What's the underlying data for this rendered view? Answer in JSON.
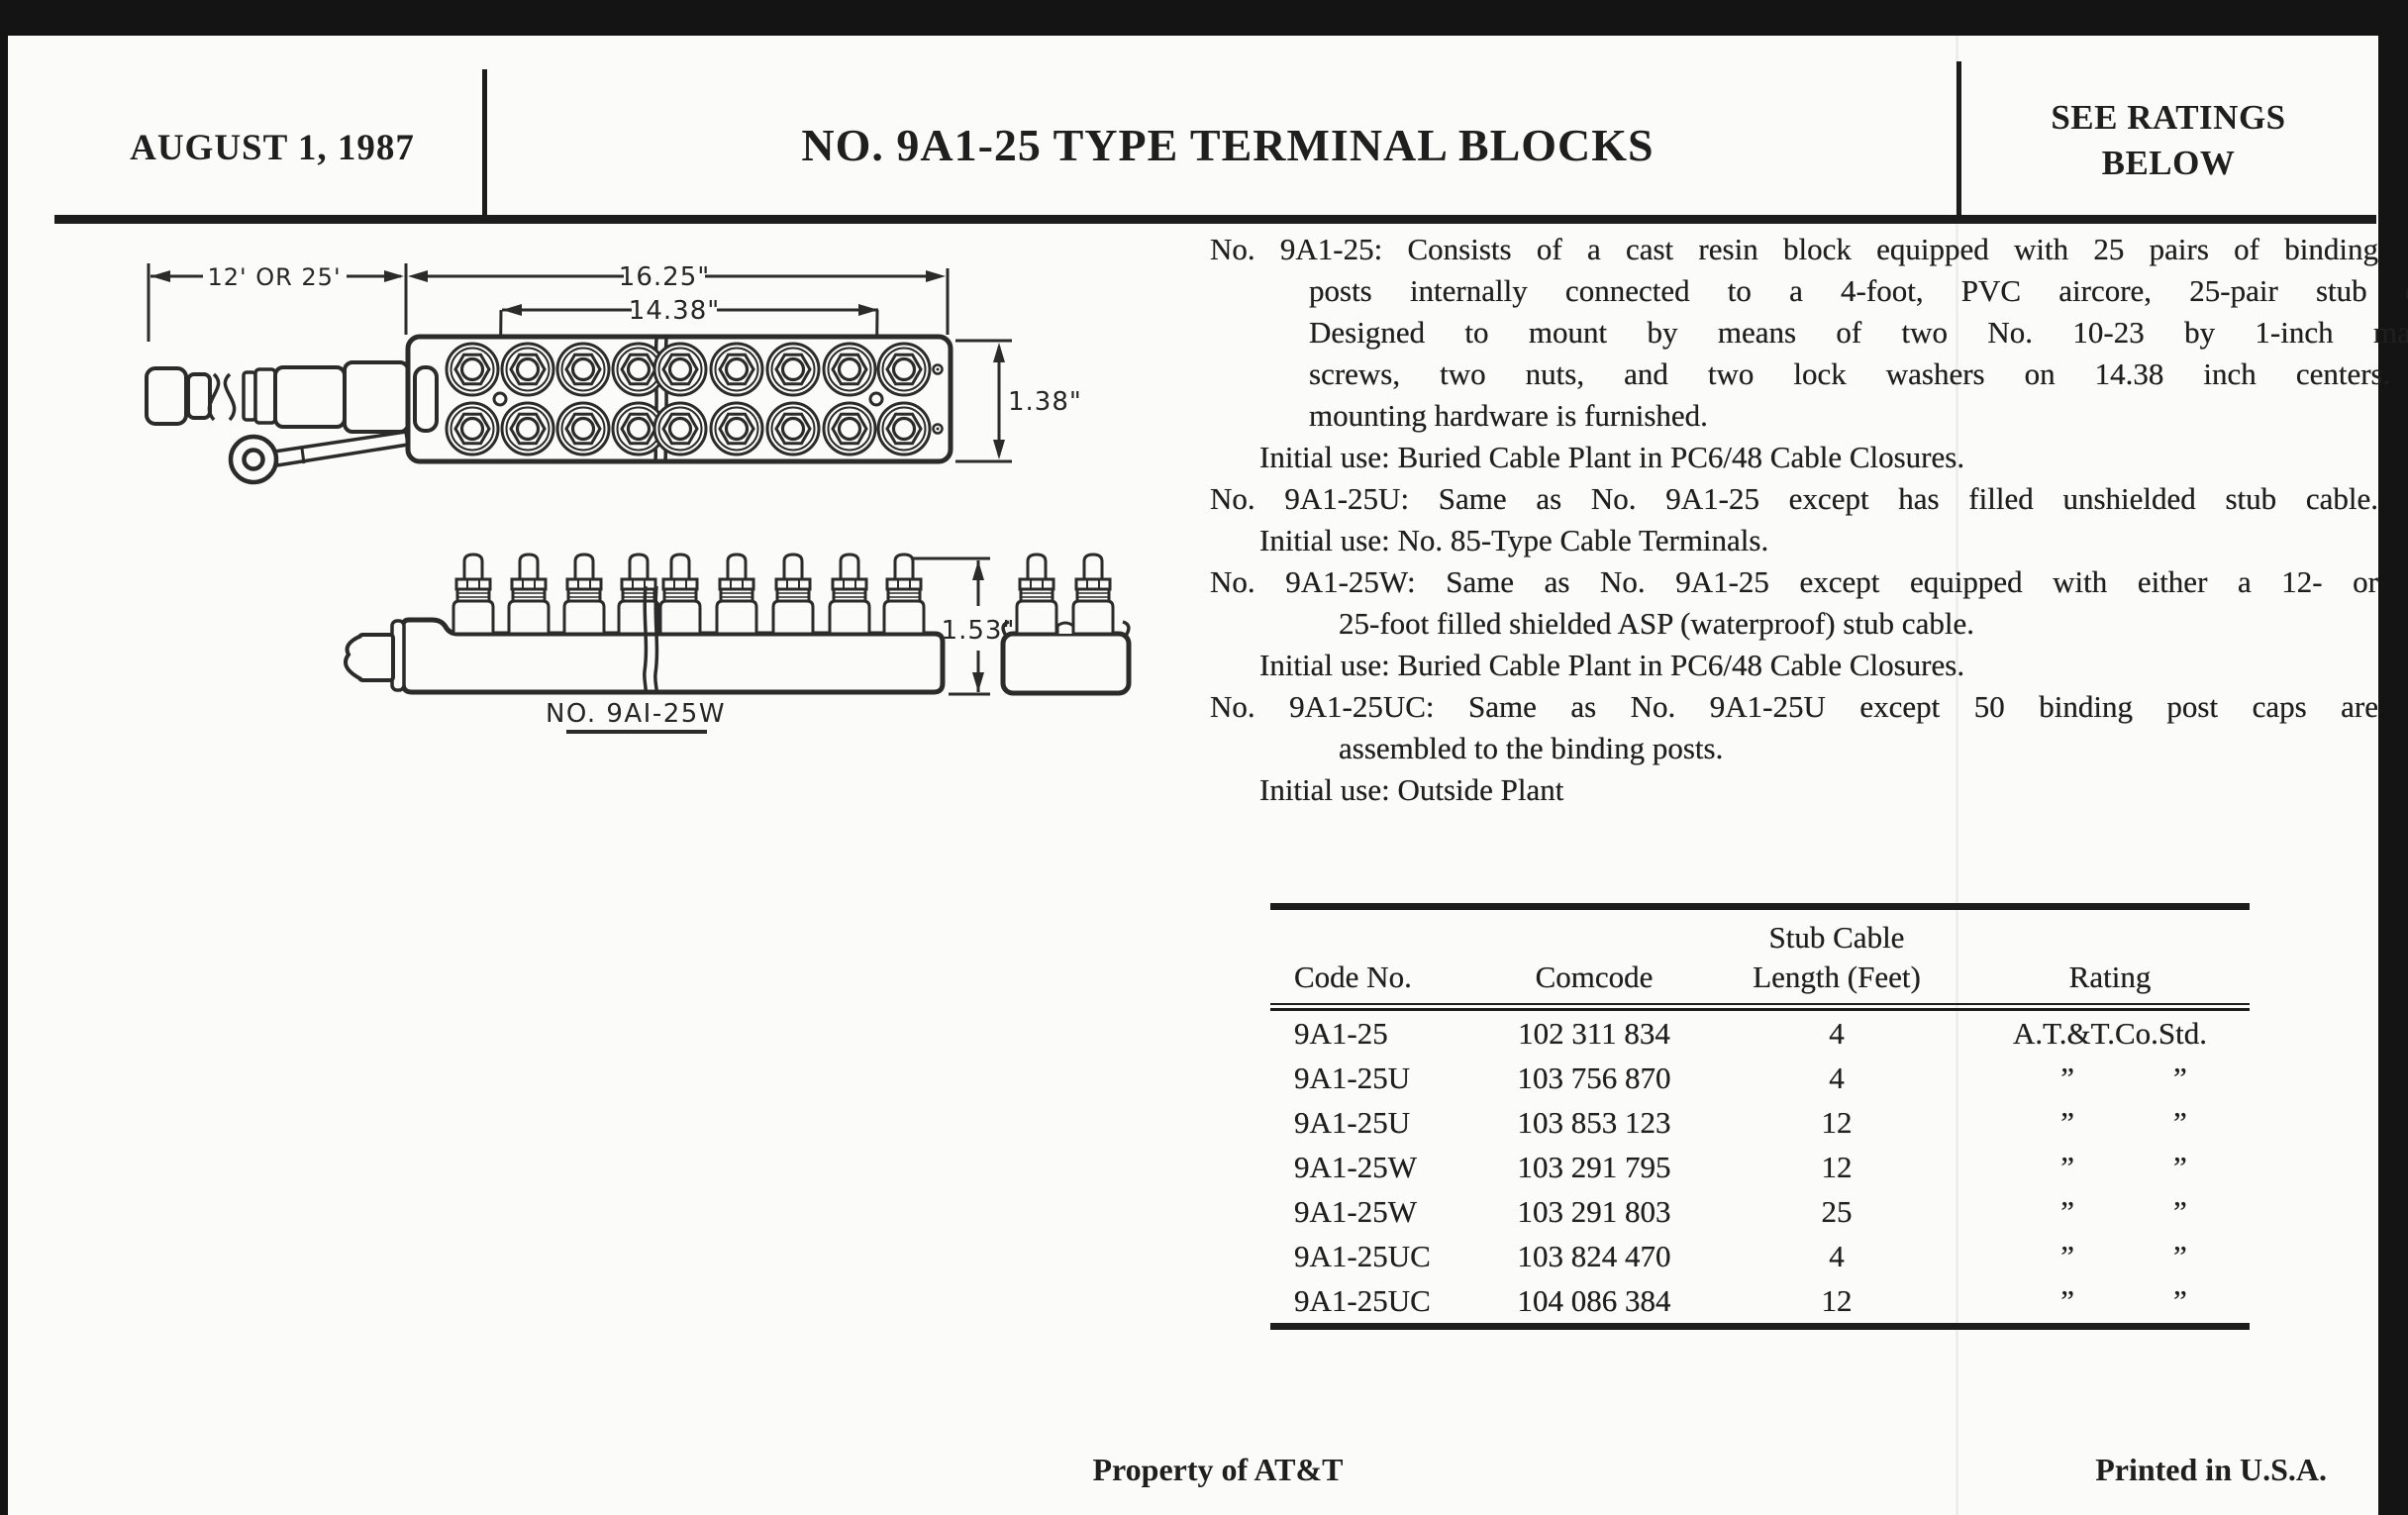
{
  "header": {
    "date": "AUGUST 1, 1987",
    "title": "NO. 9A1-25 TYPE TERMINAL BLOCKS",
    "ratings_note_line1": "SEE RATINGS",
    "ratings_note_line2": "BELOW"
  },
  "diagram": {
    "top_view": {
      "dim_cable_length": "12' OR 25'",
      "dim_overall_width": "16.25\"",
      "dim_mounting_centers": "14.38\"",
      "dim_block_height": "1.38\""
    },
    "side_view": {
      "dim_post_height": "1.53\"",
      "caption": "NO. 9AI-25W"
    }
  },
  "description": {
    "lines": [
      {
        "text": "No. 9A1-25: Consists of a cast resin block equipped with 25 pairs of binding",
        "indent": 0,
        "justify": true
      },
      {
        "text": "posts internally connected to a 4-foot, PVC aircore, 25-pair stub cable.",
        "indent": 100,
        "justify": true
      },
      {
        "text": "Designed to mount by means of two No. 10-23 by 1-inch machine",
        "indent": 100,
        "justify": true
      },
      {
        "text": "screws, two nuts, and two lock washers on 14.38 inch centers. The",
        "indent": 100,
        "justify": true
      },
      {
        "text": "mounting hardware is furnished.",
        "indent": 100,
        "justify": false
      },
      {
        "text": "Initial use: Buried Cable Plant in PC6/48 Cable Closures.",
        "indent": 50,
        "justify": false
      },
      {
        "text": "No. 9A1-25U: Same as No. 9A1-25 except has filled unshielded stub cable.",
        "indent": 0,
        "justify": true
      },
      {
        "text": "Initial use: No. 85-Type Cable Terminals.",
        "indent": 50,
        "justify": false
      },
      {
        "text": "No. 9A1-25W: Same as No. 9A1-25 except equipped with either a 12- or",
        "indent": 0,
        "justify": true
      },
      {
        "text": "25-foot filled shielded ASP (waterproof) stub cable.",
        "indent": 130,
        "justify": false
      },
      {
        "text": "Initial use: Buried Cable Plant in PC6/48 Cable Closures.",
        "indent": 50,
        "justify": false
      },
      {
        "text": "No. 9A1-25UC: Same as No. 9A1-25U except 50 binding post caps are",
        "indent": 0,
        "justify": true
      },
      {
        "text": "assembled to the binding posts.",
        "indent": 130,
        "justify": false
      },
      {
        "text": "Initial use: Outside Plant",
        "indent": 50,
        "justify": false
      }
    ]
  },
  "table": {
    "col_headers": {
      "code": "Code No.",
      "comcode": "Comcode",
      "length_line1": "Stub Cable",
      "length_line2": "Length (Feet)",
      "rating": "Rating"
    },
    "ditto_mark": "”",
    "rows": [
      {
        "code": "9A1-25",
        "comcode": "102 311 834",
        "length": "4",
        "rating": "A.T.&T.Co.Std.",
        "ditto": false
      },
      {
        "code": "9A1-25U",
        "comcode": "103 756 870",
        "length": "4",
        "rating": "",
        "ditto": true
      },
      {
        "code": "9A1-25U",
        "comcode": "103 853 123",
        "length": "12",
        "rating": "",
        "ditto": true
      },
      {
        "code": "9A1-25W",
        "comcode": "103 291 795",
        "length": "12",
        "rating": "",
        "ditto": true
      },
      {
        "code": "9A1-25W",
        "comcode": "103 291 803",
        "length": "25",
        "rating": "",
        "ditto": true
      },
      {
        "code": "9A1-25UC",
        "comcode": "103 824 470",
        "length": "4",
        "rating": "",
        "ditto": true
      },
      {
        "code": "9A1-25UC",
        "comcode": "104 086 384",
        "length": "12",
        "rating": "",
        "ditto": true
      }
    ]
  },
  "footer": {
    "left": "Property of AT&T",
    "right": "Printed in U.S.A."
  },
  "colors": {
    "paper": "#fbfbf9",
    "ink": "#1f1f1f",
    "scan_background": "#141414"
  }
}
